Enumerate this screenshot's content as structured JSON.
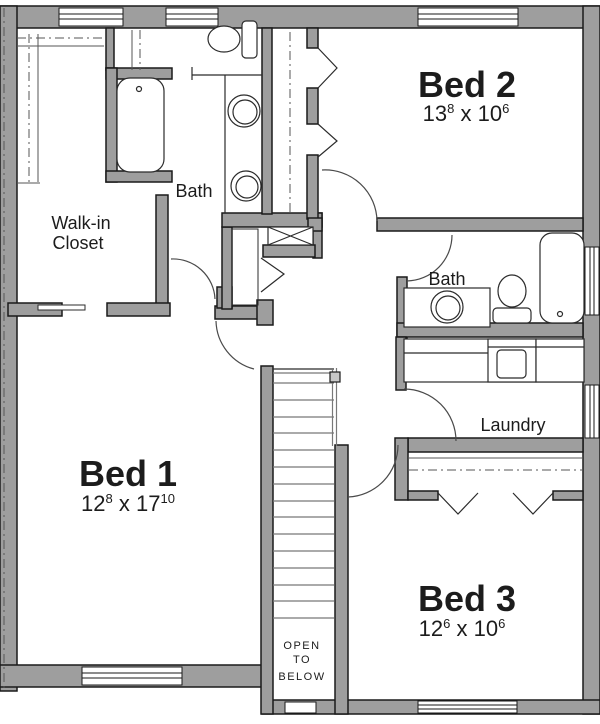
{
  "rooms": {
    "bed1": {
      "name": "Bed 1",
      "dim_part1": "12",
      "dim_sup1": "8",
      "dim_part2": " x 17",
      "dim_sup2": "10"
    },
    "bed2": {
      "name": "Bed 2",
      "dim_part1": "13",
      "dim_sup1": "8",
      "dim_part2": " x 10",
      "dim_sup2": "6"
    },
    "bed3": {
      "name": "Bed 3",
      "dim_part1": "12",
      "dim_sup1": "6",
      "dim_part2": " x 10",
      "dim_sup2": "6"
    },
    "bath_upper": {
      "name": "Bath"
    },
    "bath_hall": {
      "name": "Bath"
    },
    "laundry": {
      "name": "Laundry"
    },
    "walk_in_closet": {
      "name_line1": "Walk-in",
      "name_line2": "Closet"
    }
  },
  "stairwell": {
    "note_line1": "OPEN",
    "note_line2": "TO",
    "note_line3": "BELOW"
  },
  "colors": {
    "background": "#ffffff",
    "wall_fill": "#9e9e9e",
    "wall_outline": "#1a1a1a",
    "fixture_line": "#2b2b2b",
    "tread_line": "#787878",
    "door_arc": "#4a4a4a"
  }
}
